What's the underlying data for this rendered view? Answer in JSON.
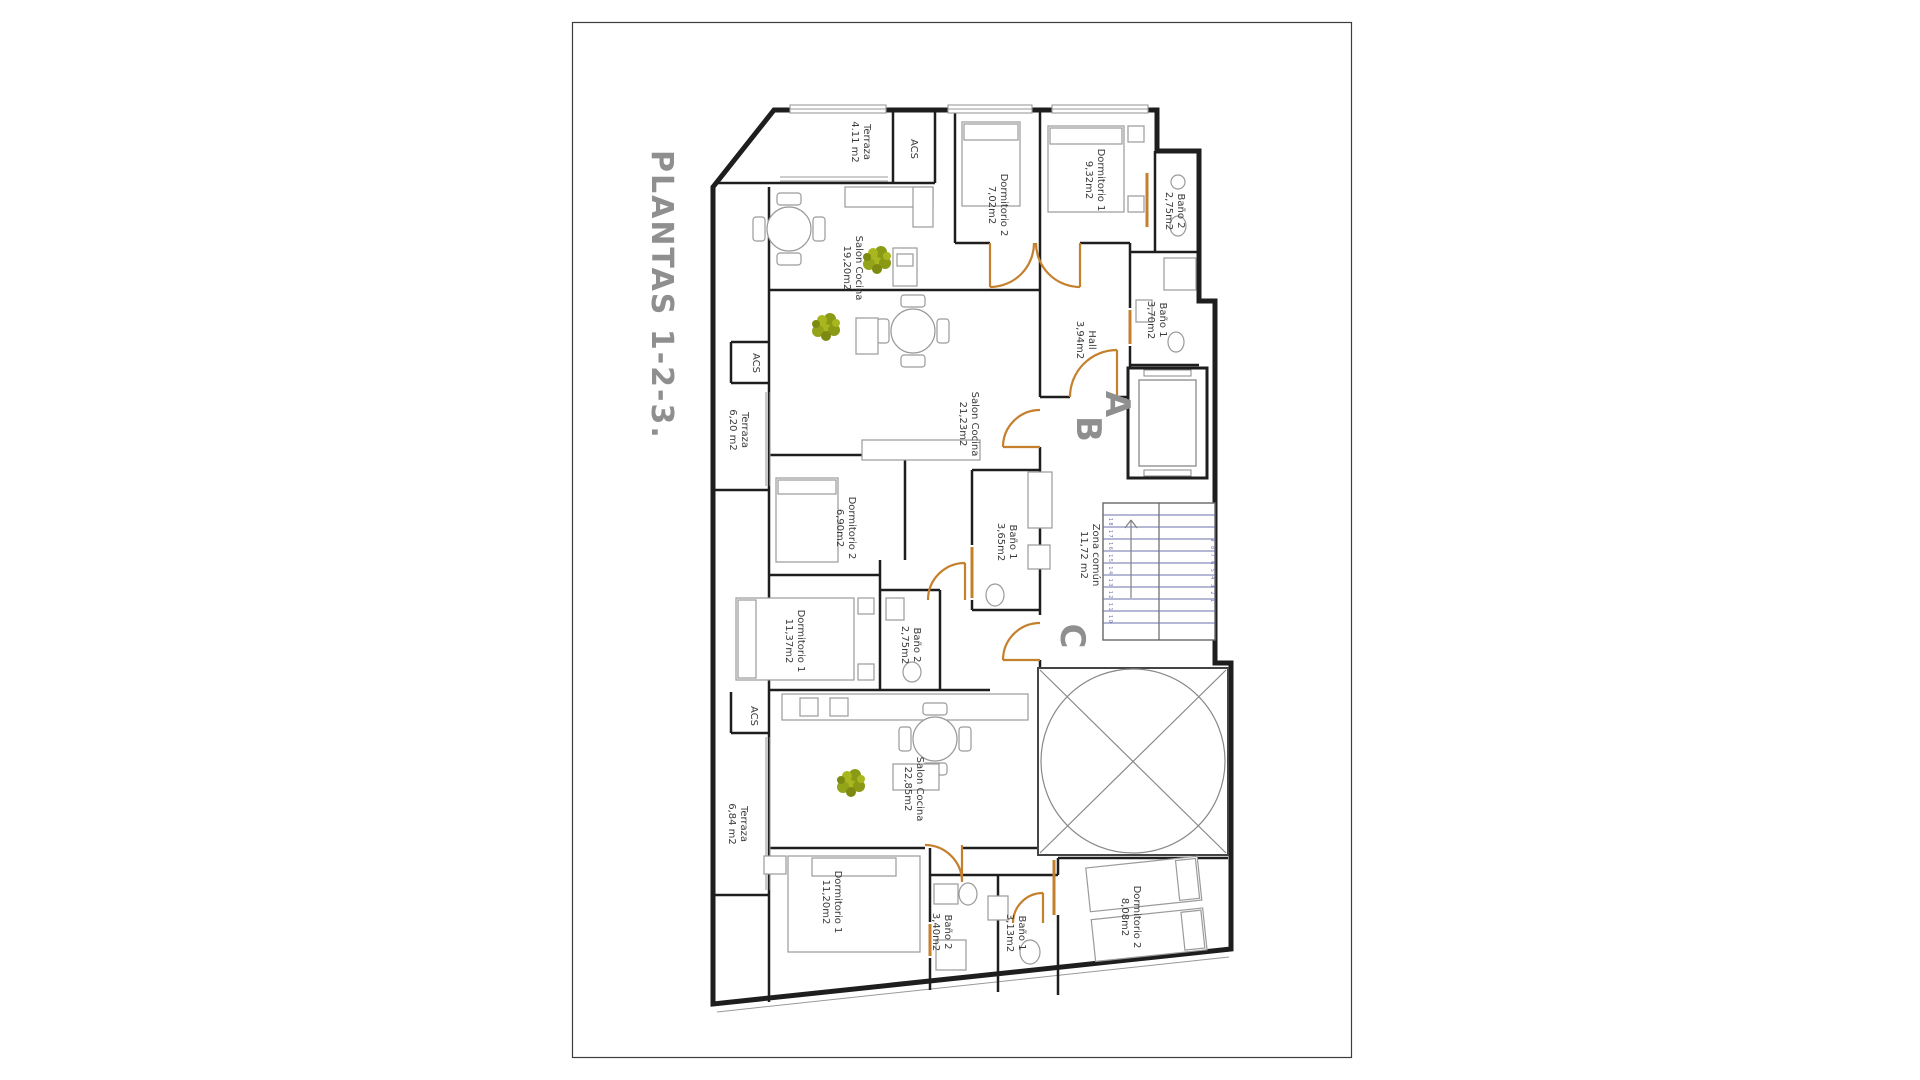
{
  "sheet": {
    "title": "PLANTAS 1-2-3."
  },
  "units": {
    "a": "A",
    "b": "B",
    "c": "C"
  },
  "stairs": {
    "left_steps": "18 17 16 15 14 13 12 11 10",
    "right_steps": "9 8 7 6 5 4 3 2 1"
  },
  "colors": {
    "wall": "#1e1e1e",
    "door": "#c5802e",
    "plant_light": "#a9b71f",
    "plant_dark": "#7c8a12",
    "stairs": "#6b70a8",
    "title_gray": "#8f8f8f",
    "label": "#3a3a3a",
    "furniture": "#9a9a9a"
  },
  "labels": [
    {
      "name": "Terraza",
      "area": "4.11 m2"
    },
    {
      "name": "ACS",
      "area": ""
    },
    {
      "name": "Dormitorio 2",
      "area": "7,02m2"
    },
    {
      "name": "Dormitorio 1",
      "area": "9,32m2"
    },
    {
      "name": "Baño 2",
      "area": "2,75m2"
    },
    {
      "name": "Salon Cocina",
      "area": "19,20m2"
    },
    {
      "name": "Hall",
      "area": "3,94m2"
    },
    {
      "name": "Baño 1",
      "area": "3,70m2"
    },
    {
      "name": "Salon Cocina",
      "area": "21,23m2"
    },
    {
      "name": "ACS",
      "area": ""
    },
    {
      "name": "Terraza",
      "area": "6,20 m2"
    },
    {
      "name": "Dormitorio 2",
      "area": "6,90m2"
    },
    {
      "name": "Baño 1",
      "area": "3,65m2"
    },
    {
      "name": "Zona común",
      "area": "11,72 m2"
    },
    {
      "name": "Dormitorio 1",
      "area": "11,37m2"
    },
    {
      "name": "Baño 2",
      "area": "2,75m2"
    },
    {
      "name": "ACS",
      "area": ""
    },
    {
      "name": "Terraza",
      "area": "6,84 m2"
    },
    {
      "name": "Salon Cocina",
      "area": "22,85m2"
    },
    {
      "name": "Dormitorio 1",
      "area": "11,20m2"
    },
    {
      "name": "Baño 2",
      "area": "3,40m2"
    },
    {
      "name": "Baño 1",
      "area": "3,13m2"
    },
    {
      "name": "Dormitorio 2",
      "area": "8,08m2"
    }
  ]
}
